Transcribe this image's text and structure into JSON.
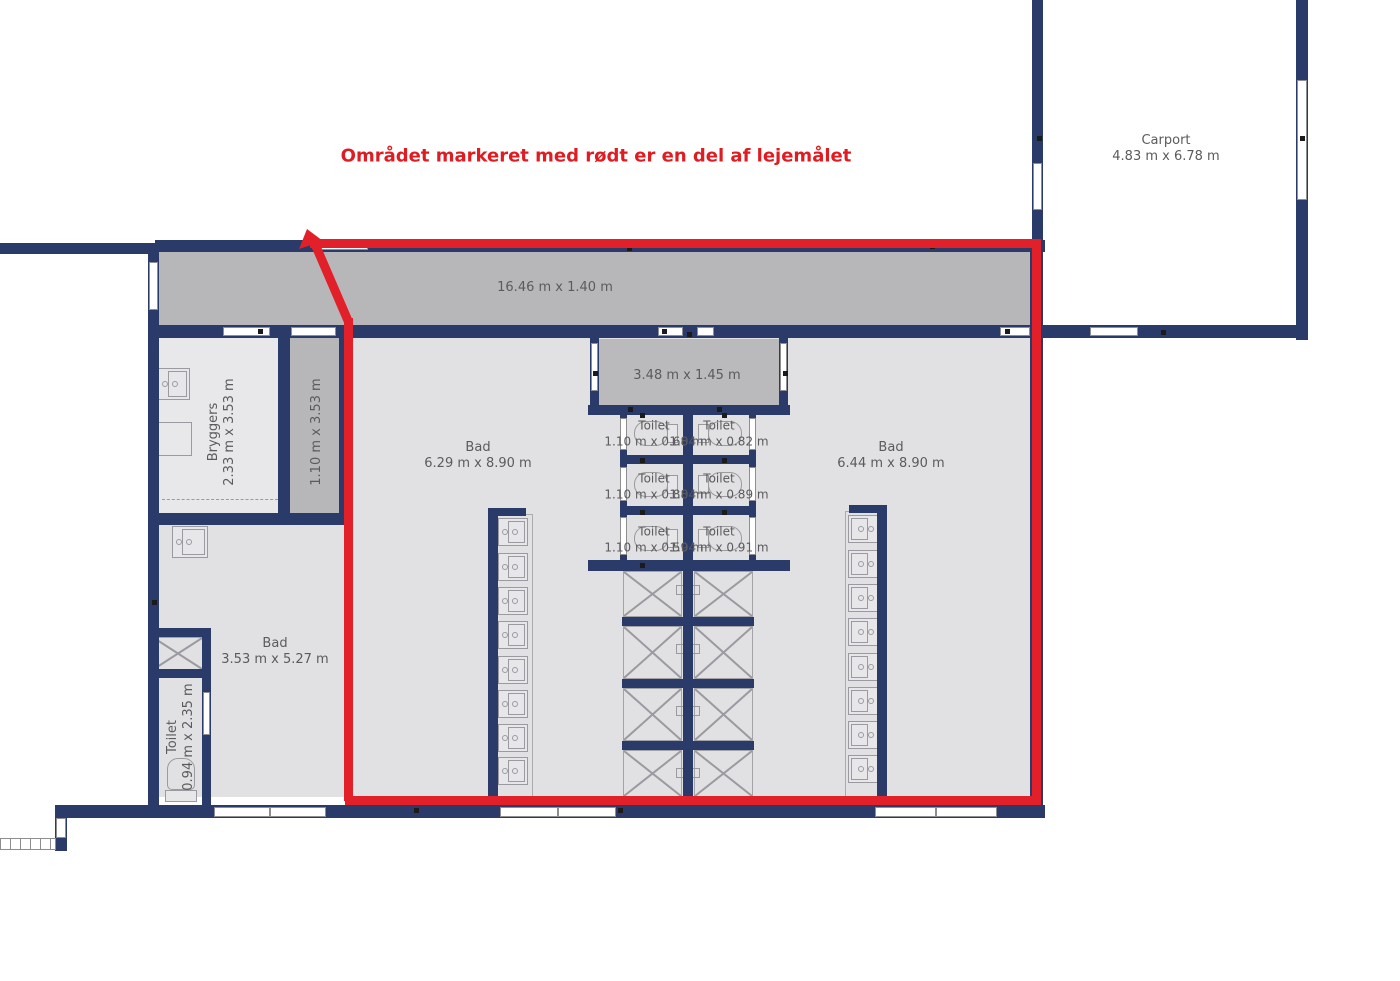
{
  "title": "Området markeret med rødt er en del af lejemålet",
  "colors": {
    "wall": "#2a3a69",
    "lease_red": "#e1202a",
    "hall_floor": "#b7b7ba",
    "mid_floor": "#bababd",
    "room_floor": "#e1e1e3",
    "utility_floor": "#e8e8ea",
    "label_text": "#5b5b5d",
    "fixture_line": "#9a9aa0"
  },
  "rooms": {
    "carport": {
      "name": "Carport",
      "dims": "4.83 m x 6.78 m"
    },
    "hallway": {
      "dims": "16.46 m x 1.40 m"
    },
    "entry": {
      "dims": "3.48 m x 1.45 m"
    },
    "bryggers": {
      "name": "Bryggers",
      "dims": "2.33 m x 3.53 m"
    },
    "closet": {
      "dims": "1.10 m x 3.53 m"
    },
    "bad_left": {
      "name": "Bad",
      "dims": "6.29 m x 8.90 m"
    },
    "bad_right": {
      "name": "Bad",
      "dims": "6.44 m x 8.90 m"
    },
    "bad_small": {
      "name": "Bad",
      "dims": "3.53 m x 5.27 m"
    },
    "toilet_small": {
      "name": "Toilet",
      "dims": "0.94 m x 2.35 m"
    }
  },
  "toilets": [
    {
      "name": "Toilet",
      "dims": "1.10 m x 0.68 m"
    },
    {
      "name": "Toilet",
      "dims": "1.04 m x 0.82 m"
    },
    {
      "name": "Toilet",
      "dims": "1.10 m x 0.88 m"
    },
    {
      "name": "Toilet",
      "dims": "1.04 m x 0.89 m"
    },
    {
      "name": "Toilet",
      "dims": "1.10 m x 0.59 m"
    },
    {
      "name": "Toilet",
      "dims": "1.04 m x 0.91 m"
    }
  ]
}
